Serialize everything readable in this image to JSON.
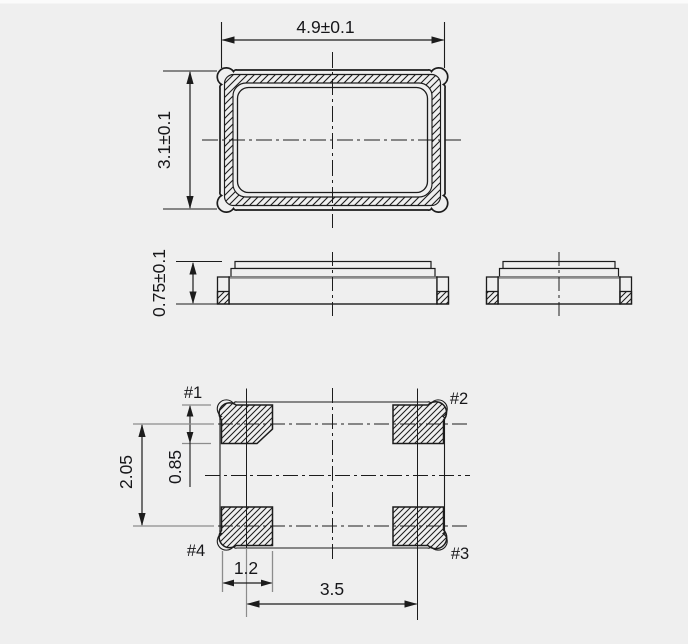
{
  "drawing": {
    "dimensions": {
      "package_width": "4.9±0.1",
      "package_length": "3.1±0.1",
      "package_height": "0.75±0.1",
      "pad_row_pitch": "2.05",
      "pad_height": "0.85",
      "pad_width": "1.2",
      "pad_column_pitch": "3.5"
    },
    "pads": [
      {
        "label": "#1"
      },
      {
        "label": "#2"
      },
      {
        "label": "#3"
      },
      {
        "label": "#4"
      }
    ],
    "colors": {
      "background": "#efefef",
      "line": "#1c1c1c",
      "gray_line": "#8c8c8c",
      "text": "#17171a"
    }
  }
}
